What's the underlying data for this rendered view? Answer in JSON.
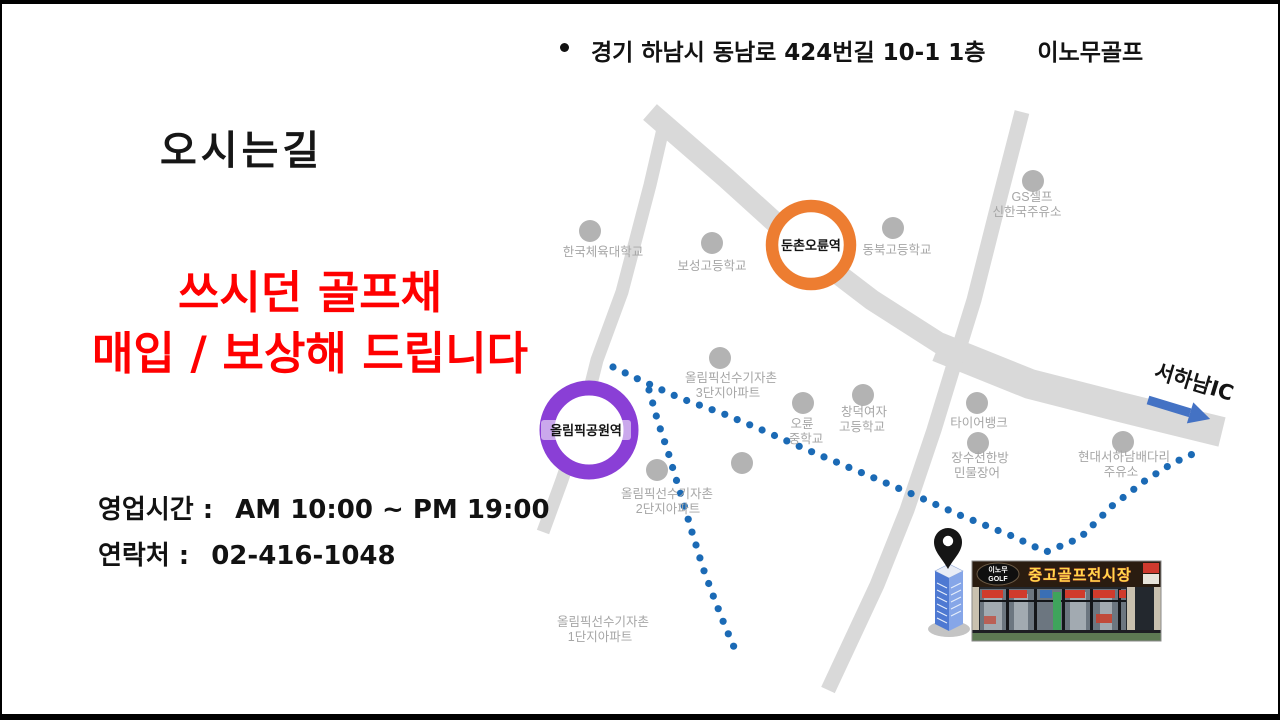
{
  "slide": {
    "address": {
      "text": "경기 하남시 동남로 424번길 10-1 1층",
      "brand": "이노무골프"
    },
    "title": "오시는길",
    "promo": {
      "line1": "쓰시던 골프채",
      "line2": "매입 / 보상해 드립니다",
      "color": "#ff0000"
    },
    "hours": {
      "label": "영업시간 :",
      "value": "AM 10:00 ~ PM 19:00"
    },
    "contact": {
      "label": "연락처 :",
      "value": "02-416-1048"
    }
  },
  "map": {
    "stations": [
      {
        "name": "둔촌오륜역",
        "ring_color": "#ED7D31"
      },
      {
        "name": "올림픽공원역",
        "ring_color": "#8A3FD6"
      }
    ],
    "landmarks": [
      {
        "lines": [
          "한국체육대학교"
        ]
      },
      {
        "lines": [
          "보성고등학교"
        ]
      },
      {
        "lines": [
          "동북고등학교"
        ]
      },
      {
        "lines": [
          "GS셀프",
          "신한국주유소"
        ]
      },
      {
        "lines": [
          "올림픽선수기자촌",
          "3단지아파트"
        ]
      },
      {
        "lines": [
          "오륜",
          "중학교"
        ]
      },
      {
        "lines": [
          "창덕여자",
          "고등학교"
        ]
      },
      {
        "lines": [
          "타이어뱅크"
        ]
      },
      {
        "lines": [
          "장수천한방",
          "민물장어"
        ]
      },
      {
        "lines": [
          "현대서하남배다리",
          "주유소"
        ]
      },
      {
        "lines": [
          "올림픽선수기자촌",
          "2단지아파트"
        ]
      },
      {
        "lines": [
          "올림픽선수기자촌",
          "1단지아파트"
        ]
      }
    ],
    "ic_label": "서하남IC",
    "store": {
      "oval_line1": "이노무",
      "oval_line2": "GOLF",
      "sign_text": "중고골프전시장"
    },
    "colors": {
      "road": "#d9d9d9",
      "landmark_dot": "#b3b3b3",
      "label_text": "#a6a6a6",
      "route_dot": "#1b6ab5",
      "arrow": "#4472C4"
    }
  }
}
